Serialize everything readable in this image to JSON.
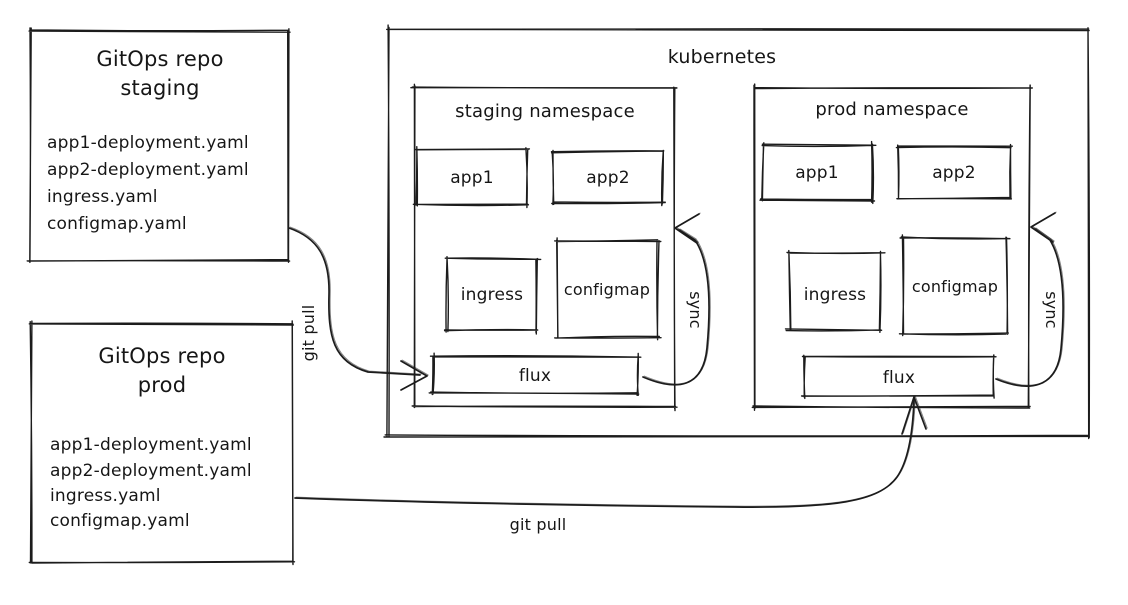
{
  "canvas": {
    "width": 1128,
    "height": 605,
    "background": "#ffffff",
    "ink": "#1c1c1c"
  },
  "diagram": {
    "nodes": [
      {
        "id": "gitops-repo-staging",
        "x": 31,
        "y": 31,
        "w": 257,
        "h": 229,
        "seed": 3,
        "texts": [
          {
            "text": "GitOps repo",
            "x": 160,
            "y": 66,
            "size": 21,
            "anchor": "middle"
          },
          {
            "text": "staging",
            "x": 160,
            "y": 95,
            "size": 21,
            "anchor": "middle"
          },
          {
            "text": "app1-deployment.yaml",
            "x": 47,
            "y": 148,
            "size": 17,
            "anchor": "start"
          },
          {
            "text": "app2-deployment.yaml",
            "x": 47,
            "y": 175,
            "size": 17,
            "anchor": "start"
          },
          {
            "text": "ingress.yaml",
            "x": 47,
            "y": 202,
            "size": 17,
            "anchor": "start"
          },
          {
            "text": "configmap.yaml",
            "x": 47,
            "y": 229,
            "size": 17,
            "anchor": "start"
          }
        ]
      },
      {
        "id": "gitops-repo-prod",
        "x": 31,
        "y": 324,
        "w": 262,
        "h": 238,
        "seed": 4,
        "texts": [
          {
            "text": "GitOps repo",
            "x": 162,
            "y": 363,
            "size": 21,
            "anchor": "middle"
          },
          {
            "text": "prod",
            "x": 162,
            "y": 392,
            "size": 21,
            "anchor": "middle"
          },
          {
            "text": "app1-deployment.yaml",
            "x": 50,
            "y": 450,
            "size": 17,
            "anchor": "start"
          },
          {
            "text": "app2-deployment.yaml",
            "x": 50,
            "y": 476,
            "size": 17,
            "anchor": "start"
          },
          {
            "text": "ingress.yaml",
            "x": 50,
            "y": 501,
            "size": 17,
            "anchor": "start"
          },
          {
            "text": "configmap.yaml",
            "x": 50,
            "y": 526,
            "size": 17,
            "anchor": "start"
          }
        ]
      },
      {
        "id": "kubernetes",
        "x": 388,
        "y": 30,
        "w": 700,
        "h": 406,
        "seed": 5,
        "texts": [
          {
            "text": "kubernetes",
            "x": 722,
            "y": 63,
            "size": 19,
            "anchor": "middle"
          }
        ]
      },
      {
        "id": "staging-namespace",
        "x": 414,
        "y": 88,
        "w": 260,
        "h": 319,
        "seed": 6,
        "texts": [
          {
            "text": "staging namespace",
            "x": 545,
            "y": 117,
            "size": 18,
            "anchor": "middle"
          }
        ]
      },
      {
        "id": "staging-app1",
        "x": 417,
        "y": 150,
        "w": 110,
        "h": 55,
        "seed": 7,
        "texts": [
          {
            "text": "app1",
            "x": 472,
            "y": 183,
            "size": 17,
            "anchor": "middle"
          }
        ]
      },
      {
        "id": "staging-app2",
        "x": 553,
        "y": 152,
        "w": 110,
        "h": 51,
        "seed": 8,
        "texts": [
          {
            "text": "app2",
            "x": 608,
            "y": 183,
            "size": 17,
            "anchor": "middle"
          }
        ]
      },
      {
        "id": "staging-ingress",
        "x": 447,
        "y": 259,
        "w": 90,
        "h": 71,
        "seed": 9,
        "texts": [
          {
            "text": "ingress",
            "x": 492,
            "y": 300,
            "size": 17,
            "anchor": "middle"
          }
        ]
      },
      {
        "id": "staging-configmap",
        "x": 557,
        "y": 241,
        "w": 101,
        "h": 96,
        "seed": 10,
        "texts": [
          {
            "text": "configmap",
            "x": 607,
            "y": 295,
            "size": 16,
            "anchor": "middle"
          }
        ]
      },
      {
        "id": "staging-flux",
        "x": 433,
        "y": 356,
        "w": 205,
        "h": 37,
        "seed": 11,
        "texts": [
          {
            "text": "flux",
            "x": 535,
            "y": 381,
            "size": 17,
            "anchor": "middle"
          }
        ]
      },
      {
        "id": "prod-namespace",
        "x": 755,
        "y": 88,
        "w": 274,
        "h": 319,
        "seed": 12,
        "texts": [
          {
            "text": "prod namespace",
            "x": 892,
            "y": 115,
            "size": 18,
            "anchor": "middle"
          }
        ]
      },
      {
        "id": "prod-app1",
        "x": 763,
        "y": 145,
        "w": 109,
        "h": 55,
        "seed": 13,
        "texts": [
          {
            "text": "app1",
            "x": 817,
            "y": 178,
            "size": 17,
            "anchor": "middle"
          }
        ]
      },
      {
        "id": "prod-app2",
        "x": 898,
        "y": 147,
        "w": 112,
        "h": 51,
        "seed": 14,
        "texts": [
          {
            "text": "app2",
            "x": 954,
            "y": 178,
            "size": 17,
            "anchor": "middle"
          }
        ]
      },
      {
        "id": "prod-ingress",
        "x": 790,
        "y": 253,
        "w": 90,
        "h": 77,
        "seed": 15,
        "texts": [
          {
            "text": "ingress",
            "x": 835,
            "y": 300,
            "size": 17,
            "anchor": "middle"
          }
        ]
      },
      {
        "id": "prod-configmap",
        "x": 903,
        "y": 238,
        "w": 104,
        "h": 95,
        "seed": 16,
        "texts": [
          {
            "text": "configmap",
            "x": 955,
            "y": 292,
            "size": 16,
            "anchor": "middle"
          }
        ]
      },
      {
        "id": "prod-flux",
        "x": 805,
        "y": 357,
        "w": 188,
        "h": 38,
        "seed": 17,
        "texts": [
          {
            "text": "flux",
            "x": 899,
            "y": 383,
            "size": 17,
            "anchor": "middle"
          }
        ]
      }
    ],
    "edges": [
      {
        "id": "git-pull-staging",
        "seed": 21,
        "path": "M 289 228 C 318 238 330 258 329 295 C 328 336 333 362 368 372 L 420 375",
        "arrow": {
          "tip": [
            427,
            376
          ],
          "barbs": [
            [
              401,
              361
            ],
            [
              401,
              390
            ]
          ]
        },
        "label": {
          "text": "git pull",
          "x": 314,
          "y": 333,
          "rotate": -90,
          "size": 16
        }
      },
      {
        "id": "git-pull-prod",
        "seed": 22,
        "path": "M 295 498 C 430 503 610 506 735 507 C 833 508 879 502 897 477 C 909 460 913 428 914 400",
        "arrow": {
          "tip": [
            914,
            397
          ],
          "barbs": [
            [
              902,
              434
            ],
            [
              926,
              429
            ]
          ]
        },
        "label": {
          "text": "git pull",
          "x": 538,
          "y": 530,
          "rotate": 0,
          "size": 16
        }
      },
      {
        "id": "sync-staging",
        "seed": 23,
        "path": "M 643 377 C 676 391 703 389 707 348 C 711 305 710 262 695 240 L 679 230",
        "arrow": {
          "tip": [
            675,
            228
          ],
          "barbs": [
            [
              699,
              214
            ],
            [
              697,
              243
            ]
          ]
        },
        "label": {
          "text": "sync",
          "x": 690,
          "y": 310,
          "rotate": 90,
          "size": 16
        }
      },
      {
        "id": "sync-prod",
        "seed": 24,
        "path": "M 996 379 C 1028 392 1057 390 1061 349 C 1065 306 1064 263 1050 240 L 1035 229",
        "arrow": {
          "tip": [
            1031,
            227
          ],
          "barbs": [
            [
              1055,
              213
            ],
            [
              1053,
              242
            ]
          ]
        },
        "label": {
          "text": "sync",
          "x": 1046,
          "y": 310,
          "rotate": 90,
          "size": 16
        }
      }
    ]
  }
}
